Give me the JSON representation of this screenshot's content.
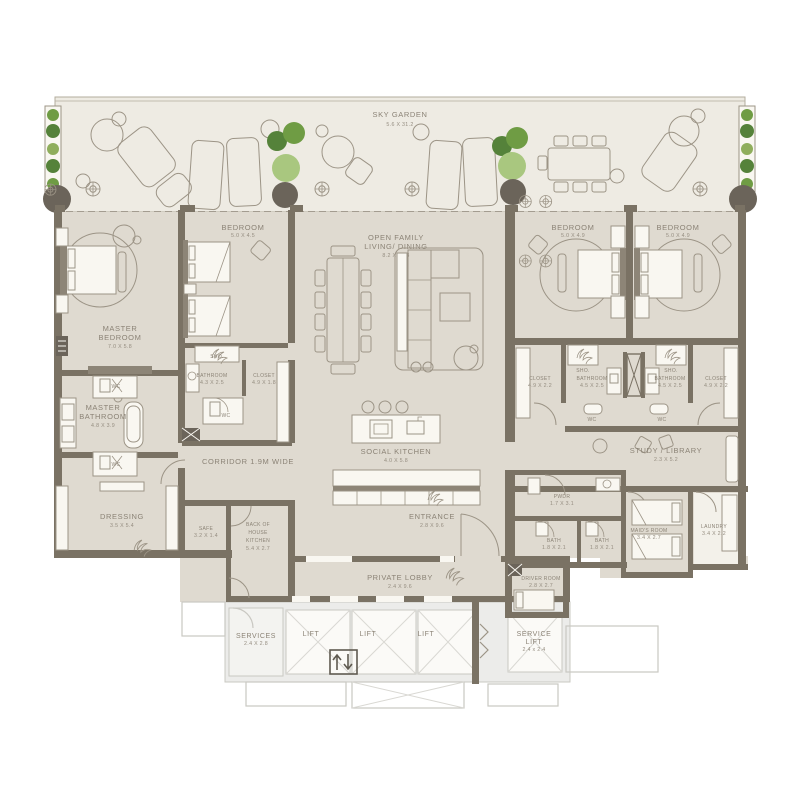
{
  "plan": {
    "sky_garden": {
      "name": "SKY GARDEN",
      "dims": "5.6 X 31.2"
    },
    "master_bedroom": {
      "l1": "MASTER",
      "l2": "BEDROOM",
      "dims": "7.0 X 5.8"
    },
    "bedroom_2": {
      "name": "BEDROOM",
      "dims": "5.0 X 4.5"
    },
    "living": {
      "l1": "OPEN FAMILY",
      "l2": "LIVING/ DINING",
      "dims": "8.2 X 10.8"
    },
    "bedroom_3": {
      "name": "BEDROOM",
      "dims": "5.0 X 4.9"
    },
    "bedroom_4": {
      "name": "BEDROOM",
      "dims": "5.0 X 4.9"
    },
    "bathroom_2": {
      "name": "BATHROOM",
      "dims": "4.3 X 2.5"
    },
    "closet_2": {
      "name": "CLOSET",
      "dims": "4.9 X 1.8"
    },
    "master_bathroom": {
      "l1": "MASTER",
      "l2": "BATHROOM",
      "dims": "4.8 X 3.9"
    },
    "dressing": {
      "name": "DRESSING",
      "dims": "3.5 X 5.4"
    },
    "corridor": {
      "name": "CORRIDOR 1.9M WIDE"
    },
    "social_kitchen": {
      "name": "SOCIAL KITCHEN",
      "dims": "4.0 X 5.8"
    },
    "closet_3": {
      "name": "CLOSET",
      "dims": "4.9 X 2.2"
    },
    "bathroom_3": {
      "name": "BATHROOM",
      "dims": "4.5 X 2.5"
    },
    "bathroom_4": {
      "name": "BATHROOM",
      "dims": "4.5 X 2.5"
    },
    "closet_4": {
      "name": "CLOSET",
      "dims": "4.9 X 2.2"
    },
    "study": {
      "name": "STUDY / LIBRARY",
      "dims": "2.3 X 5.2"
    },
    "safe": {
      "name": "SAFE",
      "dims": "3.2 X 1.4"
    },
    "boh_kitchen": {
      "l1": "BACK OF",
      "l2": "HOUSE",
      "l3": "KITCHEN",
      "dims": "5.4 X 2.7"
    },
    "entrance": {
      "name": "ENTRANCE",
      "dims": "2.8 X 9.6"
    },
    "private_lobby": {
      "name": "PRIVATE LOBBY",
      "dims": "2.4 X 9.6"
    },
    "pwdr": {
      "name": "PWDR",
      "dims": "1.7 X 3.1"
    },
    "bath_1": {
      "name": "BATH",
      "dims": "1.8 X 2.1"
    },
    "bath_2": {
      "name": "BATH",
      "dims": "1.8 X 2.1"
    },
    "maids_room": {
      "name": "MAID'S ROOM",
      "dims": "3.4 X 2.7"
    },
    "laundry": {
      "name": "LAUNDRY",
      "dims": "3.4 X 2.2"
    },
    "driver_room": {
      "name": "DRIVER ROOM",
      "dims": "2.8 X 2.7"
    },
    "services": {
      "name": "SERVICES",
      "dims": "2.4 X 2.8"
    },
    "lift_1": {
      "name": "LIFT"
    },
    "lift_2": {
      "name": "LIFT"
    },
    "lift_3": {
      "name": "LIFT"
    },
    "service_lift": {
      "l1": "SERVICE",
      "l2": "LIFT",
      "dims": "2.4 x 2.4"
    },
    "wc": "WC",
    "sho": "SHO."
  },
  "colors": {
    "wall": "#7a7264",
    "floor": "#dfdad0",
    "sky_garden_floor": "#eeebe3",
    "fixture_white": "#f9f7f1",
    "text": "#8b8376",
    "plant_green": "#6f9c44",
    "plant_light_green": "#a9c77f",
    "core_gray": "#c9c8c2"
  }
}
